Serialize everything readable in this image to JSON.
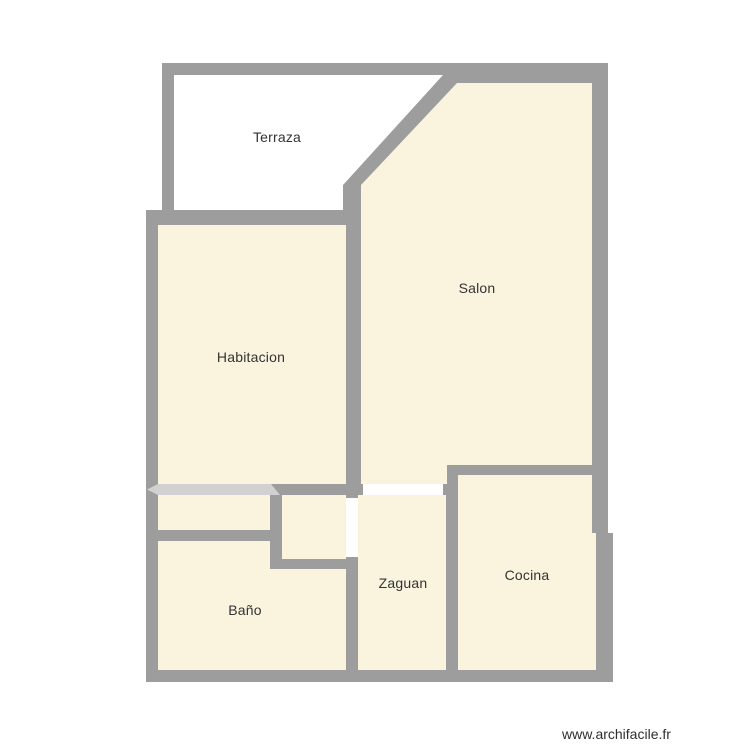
{
  "page": {
    "title": "Floor plan",
    "watermark": "www.archifacile.fr",
    "background": "#ffffff"
  },
  "colors": {
    "wall": "#9d9d9d",
    "room_fill": "#faf4df",
    "terrace_fill": "#ffffff",
    "opening_fill": "#ffffff",
    "sliding_door_fill": "#d1d1d1",
    "label_text": "#333333",
    "watermark_text": "#2f2f2f"
  },
  "rooms": [
    {
      "id": "terraza",
      "label": "Terraza"
    },
    {
      "id": "salon",
      "label": "Salon"
    },
    {
      "id": "habitacion",
      "label": "Habitacion"
    },
    {
      "id": "zaguan",
      "label": "Zaguan"
    },
    {
      "id": "bano",
      "label": "Baño"
    },
    {
      "id": "cocina",
      "label": "Cocina"
    }
  ]
}
